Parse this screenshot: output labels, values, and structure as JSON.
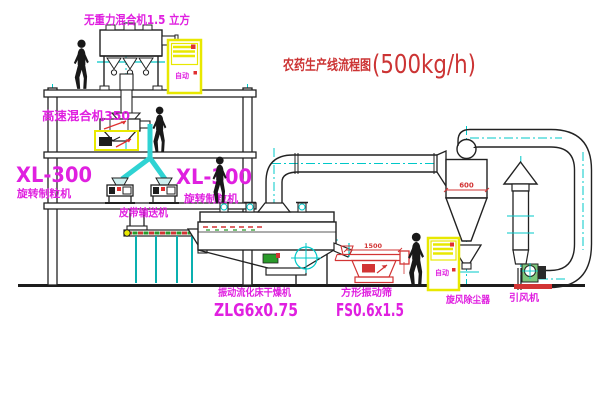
{
  "title": {
    "name": "农药生产线流程图",
    "capacity": "(500kg/h)"
  },
  "labels": {
    "gravity_mixer": "无重力混合机1.5 立方",
    "high_speed_mixer": "高速混合机350",
    "granulator_left": {
      "model": "XL-300",
      "name": "旋转制粒机"
    },
    "granulator_mid": {
      "model": "XL-300",
      "name": "旋转制粒机"
    },
    "belt_conveyor": "皮带输送机",
    "dryer": {
      "name": "振动流化床干燥机",
      "model": "ZLG6x0.75"
    },
    "sieve": {
      "name": "方形振动筛",
      "model": "FS0.6x1.5"
    },
    "cyclone": "旋风除尘器",
    "fan": "引风机",
    "cabinet": "自动"
  },
  "dimensions": {
    "sieve_length": "1500",
    "cyclone_diameter": "600"
  },
  "colors": {
    "label_magenta": "#e020e0",
    "title_red": "#cc3434",
    "line_black": "#222222",
    "centerline_cyan": "#00c8c8",
    "highlight_yellow": "#e8e800",
    "accent_red": "#d23434",
    "accent_green": "#2a9a2a"
  }
}
